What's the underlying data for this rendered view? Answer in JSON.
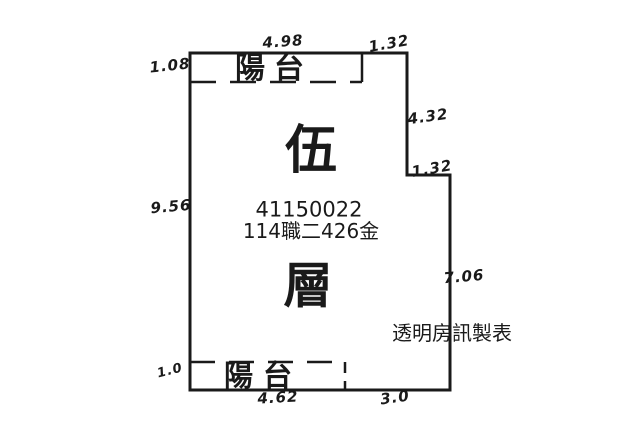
{
  "plan": {
    "floor_char_top": "伍",
    "floor_char_bottom": "層",
    "registration_number": "41150022",
    "case_label": "114職二426金",
    "credit": "透明房訊製表",
    "balcony_top": "陽台",
    "balcony_bottom": "陽台"
  },
  "dimensions": {
    "top": "4.98",
    "top_right": "1.32",
    "left_balcony": "1.08",
    "left": "9.56",
    "right_upper": "4.32",
    "right_step": "1.32",
    "right_lower": "7.06",
    "bottom_balcony": "1.0",
    "bottom_left": "4.62",
    "bottom_right": "3.0"
  },
  "colors": {
    "line": "#1a1a1a",
    "background": "#ffffff"
  }
}
